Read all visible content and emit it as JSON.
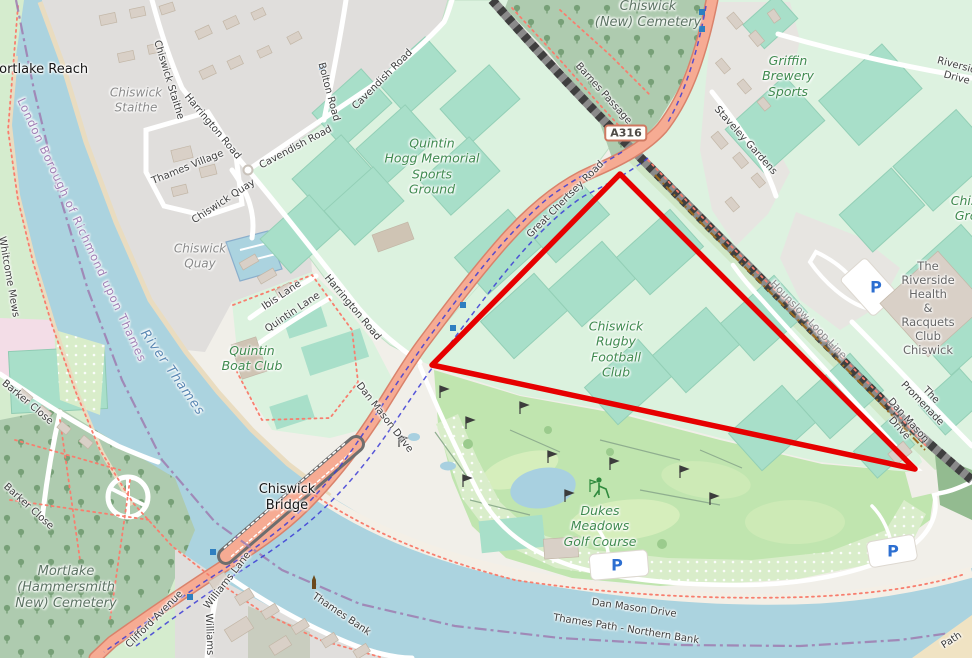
{
  "badges": {
    "a316": "A316"
  },
  "icons": {
    "parking": "P"
  },
  "annotation": {
    "triangle_color": "#e60000"
  },
  "labels": {
    "mortlake_reach": "Mortlake Reach",
    "chiswick_staithe_area": "Chiswick\nStaithe",
    "chiswick_staithe_road": "Chiswick Staithe",
    "harrington_road_n": "Harrington Road",
    "harrington_road_s": "Harrington Road",
    "thames_village": "Thames Village",
    "chiswick_quay_road": "Chiswick Quay",
    "chiswick_quay_area": "Chiswick\nQuay",
    "cavendish_road_w": "Cavendish Road",
    "cavendish_road_n": "Cavendish Road",
    "bolton_road": "Bolton Road",
    "quintin_hogg": "Quintin\nHogg Memorial\nSports\nGround",
    "chiswick_new_cemetery": "Chiswick\n(New) Cemetery",
    "barnes_passage": "Barnes Passage",
    "great_chertsey_road": "Great Chertsey Road",
    "griffin_brewery": "Griffin\nBrewery\nSports",
    "staveley_gardens": "Staveley Gardens",
    "riverside_drive": "Riverside Drive",
    "chiswick_ground": "Chiswick\nGround",
    "riverside_club": "The Riverside\nHealth\n& Racquets\nClub\nChiswick",
    "hounslow_loop_line": "Hounslow Loop Line",
    "the_promenade": "The Promenade",
    "dan_mason_ne": "Dan Mason Drive",
    "dan_mason_w": "Dan Mason Drive",
    "dan_mason_s": "Dan Mason Drive",
    "chiswick_rugby": "Chiswick\nRugby\nFootball\nClub",
    "quintin_boat_club": "Quintin\nBoat Club",
    "ibis_lane": "Ibis Lane",
    "quintin_lane": "Quintin Lane",
    "river_thames": "River Thames",
    "borough_boundary": "London Borough of Richmond upon Thames",
    "barker_close_1": "Barker Close",
    "barker_close_2": "Barker Close",
    "whitcome_mews": "Whitcome Mews",
    "mortlake_cemetery": "Mortlake\n(Hammersmith\nNew) Cemetery",
    "chiswick_bridge": "Chiswick\nBridge",
    "clifford_avenue": "Clifford Avenue",
    "williams_lane_1": "Williams Lane",
    "williams_lane_2": "Williams Lane",
    "thames_bank": "Thames Bank",
    "dukes_meadows": "Dukes\nMeadows\nGolf Course",
    "thames_path_northern_bank": "Thames Path - Northern Bank",
    "path_corner": "Path"
  }
}
